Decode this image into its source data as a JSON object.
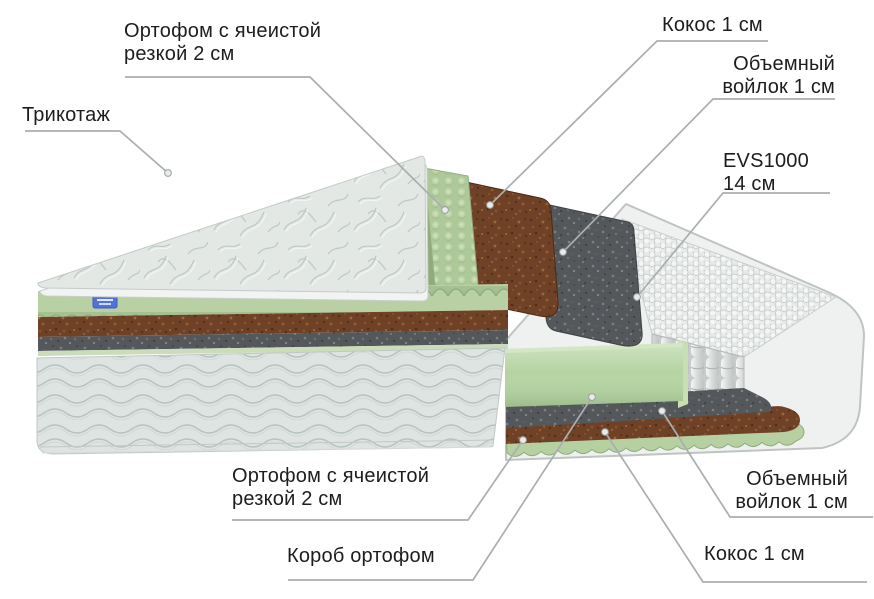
{
  "labels": {
    "ortofoam_top": "Ортофом с ячеистой\nрезкой 2 см",
    "tricot": "Трикотаж",
    "coconut_top": "Кокос 1 см",
    "felt_top": "Объемный\nвойлок 1 см",
    "springs_block": "EVS1000\n14 см",
    "ortofoam_bottom": "Ортофом с ячеистой\nрезкой 2 см",
    "foam_box": "Короб ортофом",
    "felt_bottom": "Объемный\nвойлок 1 см",
    "coconut_bottom": "Кокос 1 см"
  },
  "illustration": {
    "type": "mattress-layers-cutaway",
    "colors": {
      "quilt": "#e3e8e5",
      "body_fabric": "#dee4e1",
      "eggcrate": "#aec999",
      "eggcrate_front": "#a5c091",
      "coconut": "#6f4227",
      "felt": "#54585b",
      "springs": "#e7eae8",
      "foam_box": "#b5d4a2",
      "shell": "#eff1f0",
      "brand_tag": "#5272d8",
      "leader_line": "#a9afae",
      "label_text": "#1d1d1d"
    }
  }
}
